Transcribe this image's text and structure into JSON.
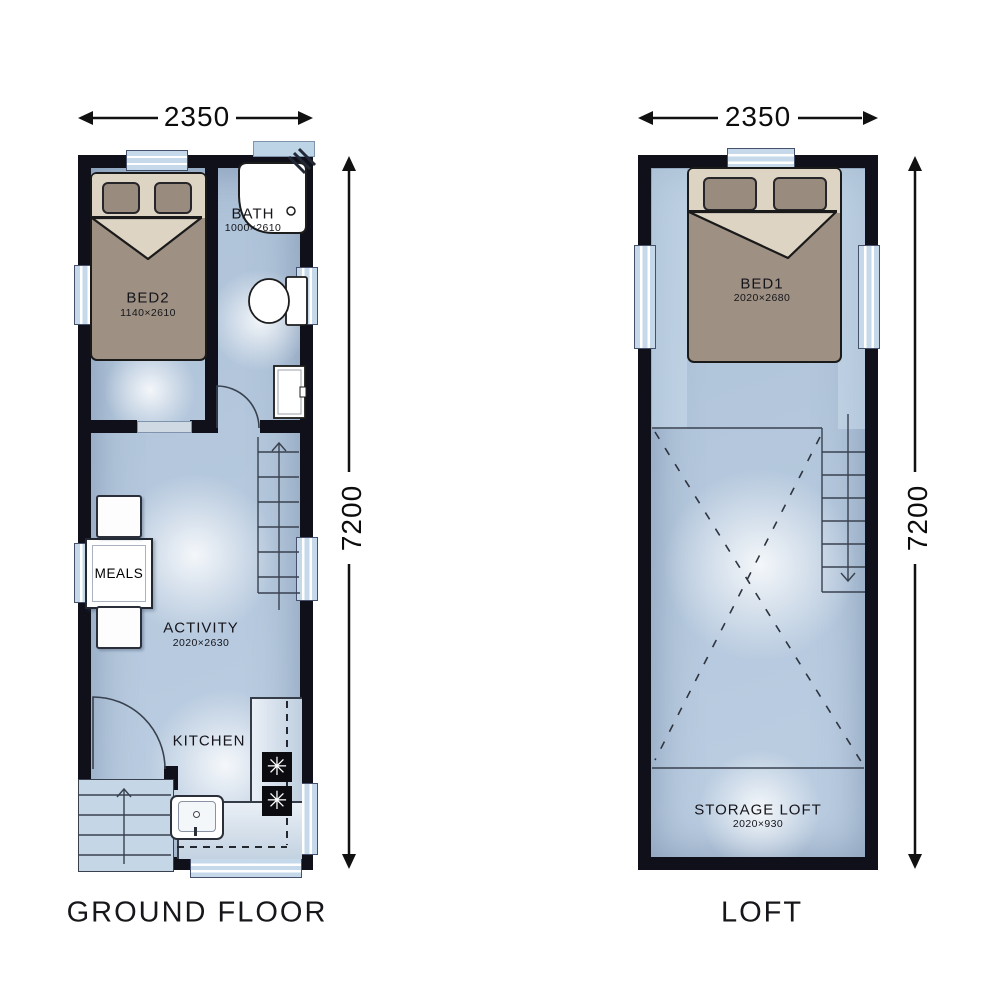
{
  "ground_floor": {
    "title": "GROUND FLOOR",
    "dims": {
      "width": "2350",
      "length": "7200"
    },
    "rooms": {
      "bed2": {
        "label": "BED2",
        "size": "1140×2610"
      },
      "bath": {
        "label": "BATH",
        "size": "1000×2610"
      },
      "meals": {
        "label": "MEALS"
      },
      "activity": {
        "label": "ACTIVITY",
        "size": "2020×2630"
      },
      "kitchen": {
        "label": "KITCHEN"
      }
    }
  },
  "loft": {
    "title": "LOFT",
    "dims": {
      "width": "2350",
      "length": "7200"
    },
    "rooms": {
      "bed1": {
        "label": "BED1",
        "size": "2020×2680"
      },
      "storage_loft": {
        "label": "STORAGE LOFT",
        "size": "2020×930"
      }
    }
  },
  "icons": {
    "burner": "✳"
  },
  "colors": {
    "wall": "#10101a",
    "floor": "#b5c8dd",
    "window": "#c6d9ea",
    "bed_frame": "#9e9184",
    "bed_head": "#ddd4c3",
    "pillow": "#998c7e",
    "fixture_white": "#ffffff",
    "line": "#2e3440",
    "text": "#1c1c1c",
    "background": "#ffffff"
  }
}
